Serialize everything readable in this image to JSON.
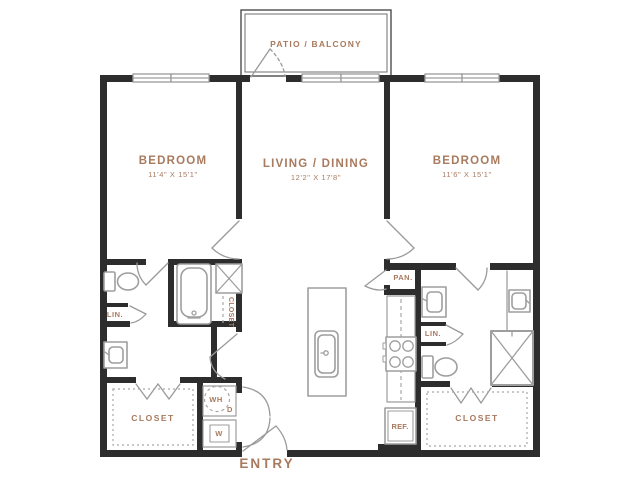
{
  "plan_title": "2 Bedroom / 2 Bath Floor Plan",
  "palette": {
    "wall": "#2d2d2d",
    "fixture": "#9e9e9e",
    "label": "#a87a5e",
    "background": "#ffffff"
  },
  "rooms": {
    "patio_balcony": {
      "label": "PATIO / BALCONY"
    },
    "bedroom_left": {
      "label": "BEDROOM",
      "dimensions": "11'4\" X 15'1\""
    },
    "living_dining": {
      "label": "LIVING / DINING",
      "dimensions": "12'2\" X 17'8\""
    },
    "bedroom_right": {
      "label": "BEDROOM",
      "dimensions": "11'6\" X 15'1\""
    },
    "closet_bedroom_left": {
      "label": "CLOSET"
    },
    "closet_bathroom_left": {
      "label": "CLOSET"
    },
    "closet_bedroom_right": {
      "label": "CLOSET"
    },
    "linen_left": {
      "label": "LIN."
    },
    "linen_right": {
      "label": "LIN."
    },
    "pantry": {
      "label": "PAN."
    },
    "entry": {
      "label": "ENTRY"
    }
  },
  "appliances": {
    "water_heater": {
      "label": "WH"
    },
    "dryer": {
      "label": "D"
    },
    "washer": {
      "label": "W"
    },
    "refrigerator": {
      "label": "REF."
    }
  }
}
